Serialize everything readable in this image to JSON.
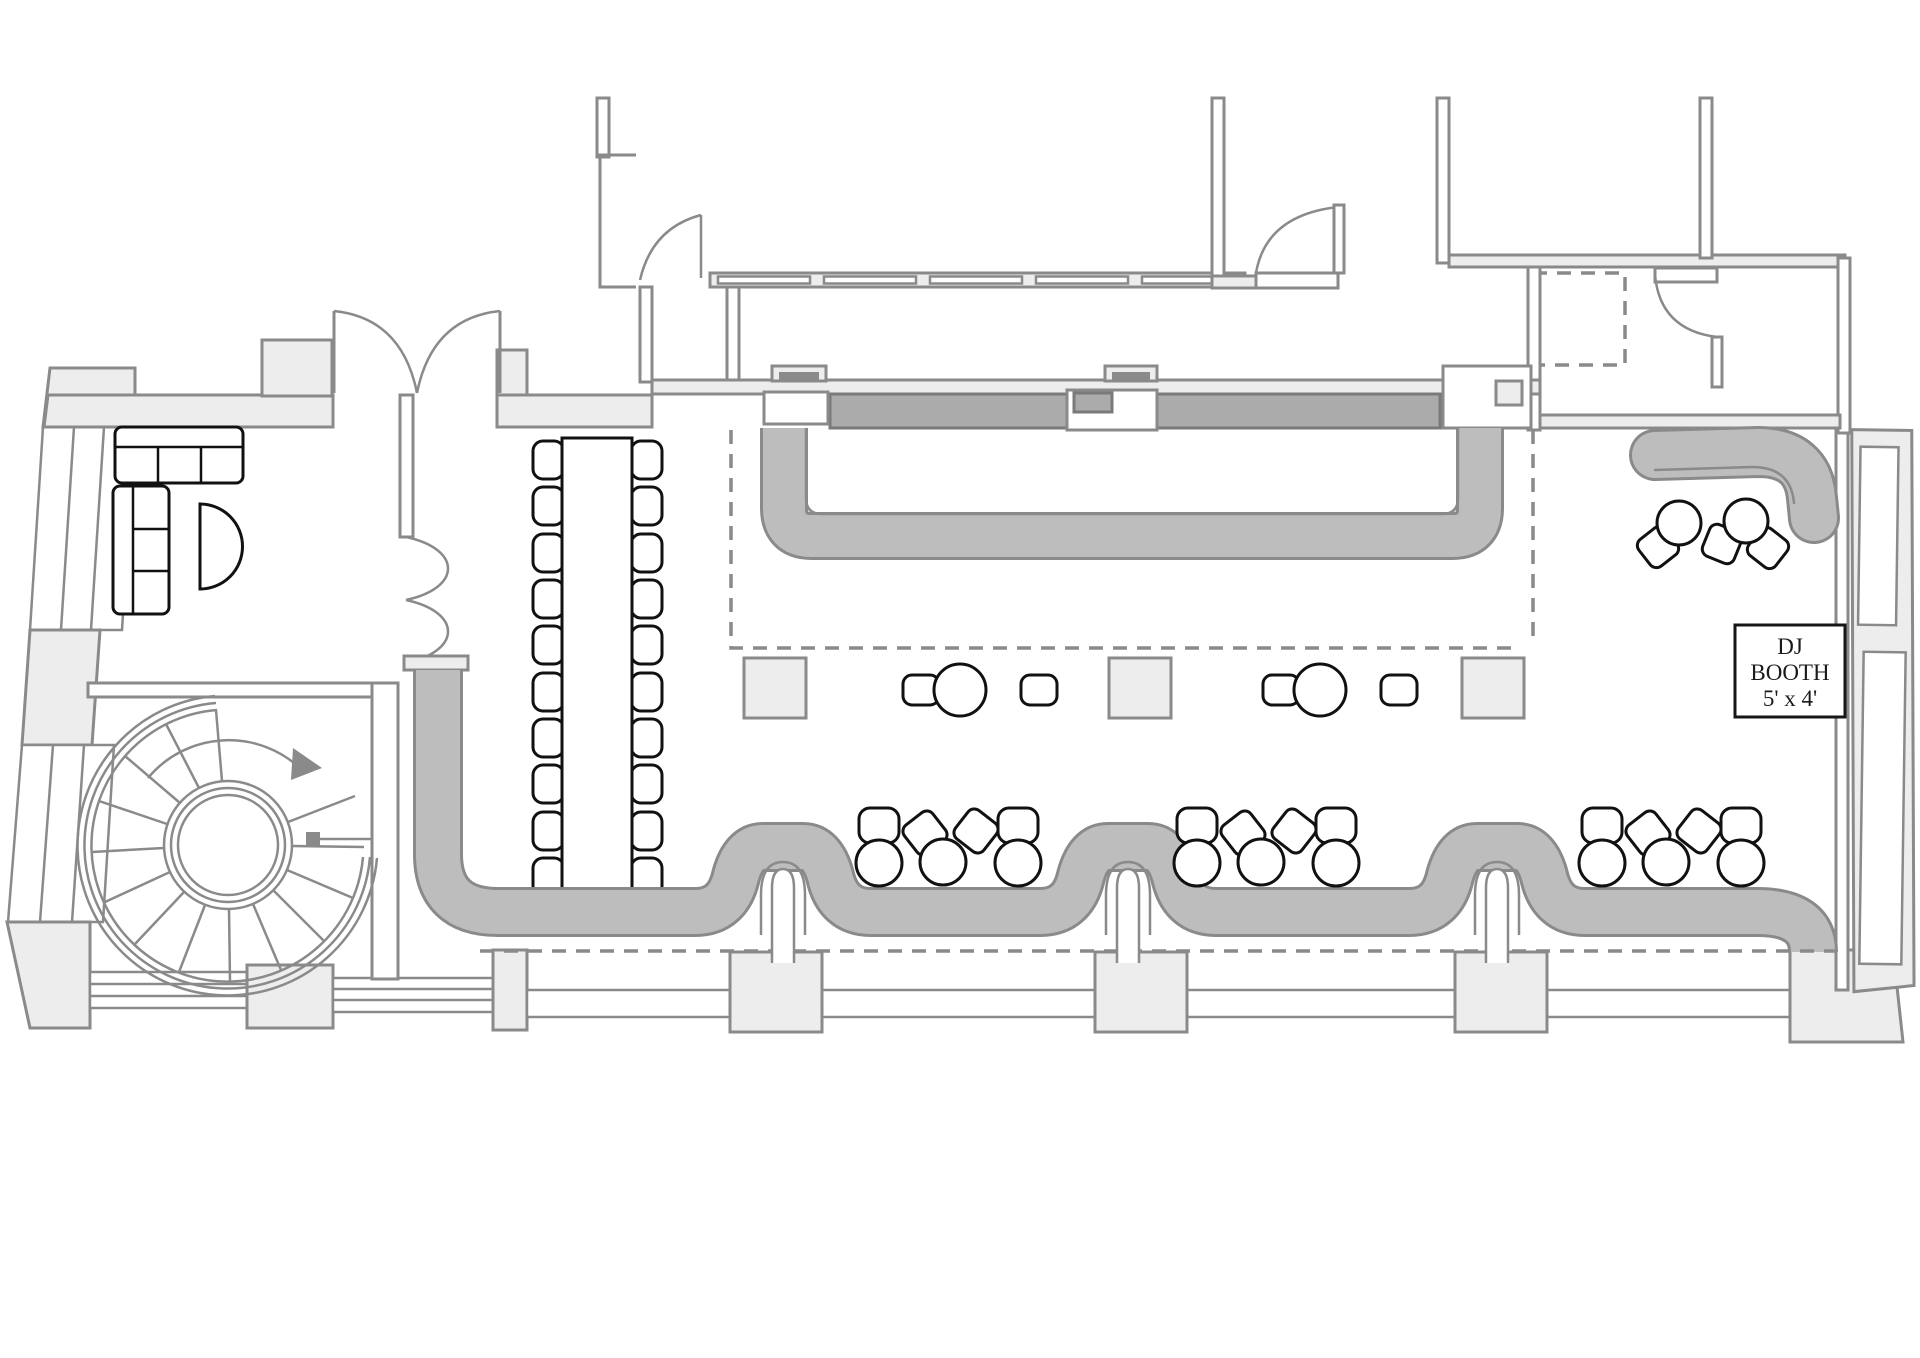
{
  "page": {
    "background": "#ffffff",
    "type": "venue-floor-plan"
  },
  "dj_booth": {
    "line1": "DJ",
    "line2": "BOOTH",
    "line3": "5' x 4'"
  },
  "colors": {
    "page_bg": "#ffffff",
    "wall_fill": "#ededed",
    "wall_stroke": "#8a8a8a",
    "band_fill": "#bdbdbd",
    "band_stroke": "#8a8a8a",
    "backbar_fill": "#ababab",
    "backbar_stroke": "#7a7a7a",
    "furniture_stroke": "#111111",
    "dash_stroke": "#8a8a8a",
    "dj_text": "#1a1a1a",
    "dj_border": "#161616"
  },
  "inventory": {
    "spiral_staircase": 1,
    "long_table_seats": 20,
    "lounge_sofa_sections": 2,
    "half_round_table": 1,
    "cocktail_tables": 2,
    "structural_columns": 3,
    "banquette_bays": 3,
    "bay_tables_each": 3,
    "right_lounge_tables": 2,
    "right_lounge_chairs": 3,
    "dj_booth": 1
  }
}
